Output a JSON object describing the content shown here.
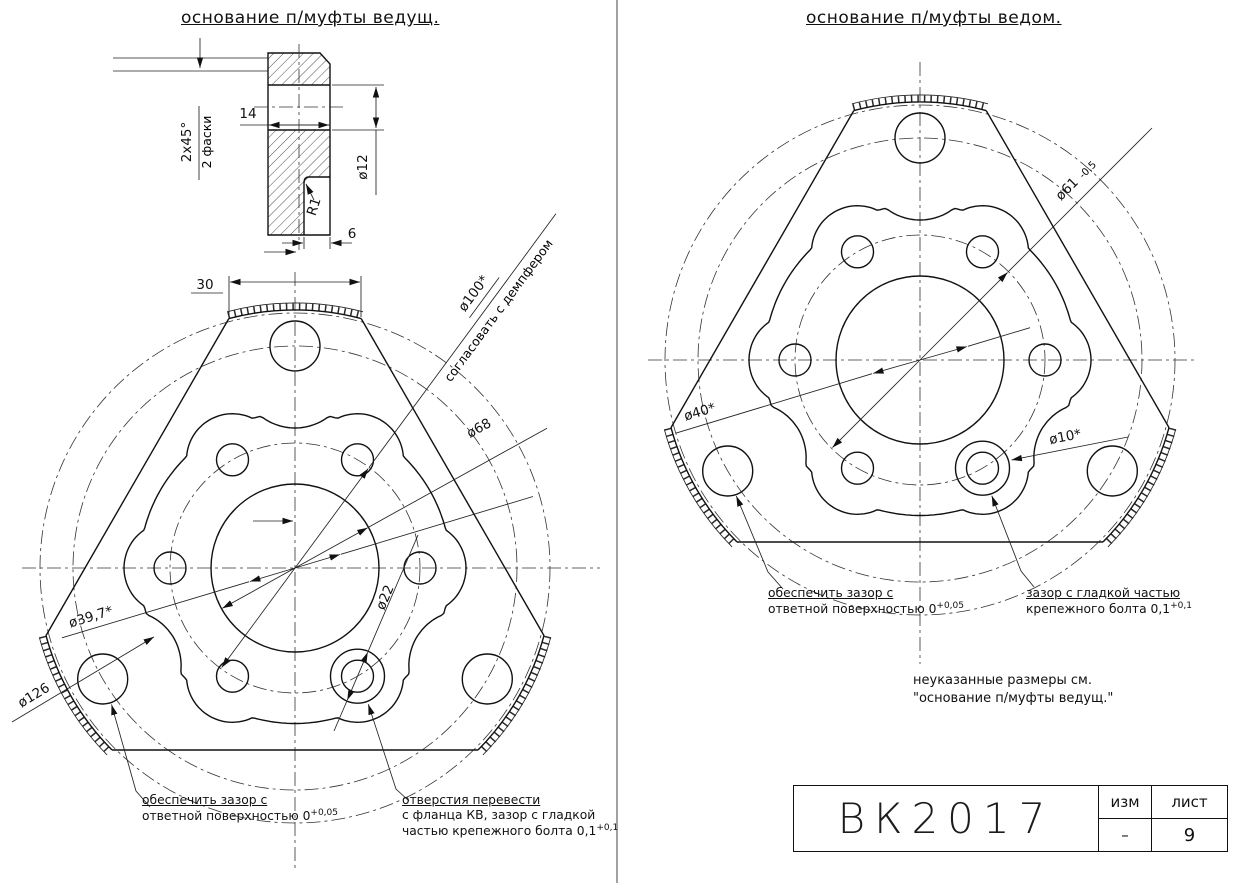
{
  "left_view": {
    "title": "основание п/муфты ведущ.",
    "section": {
      "chamfer_line1": "2x45°",
      "chamfer_line2": "2 фаски",
      "width": "14",
      "bore": "ø12",
      "radius": "R1",
      "slot": "6"
    },
    "dims": {
      "flat": "30",
      "bolt_circle": "ø100*",
      "bolt_circle_note": "согласовать с демпфером",
      "bore": "ø68",
      "counterbore": "ø22",
      "fit": "ø39,7*",
      "flange": "ø126"
    },
    "notes": {
      "clearance": {
        "line1": "обеспечить зазор с",
        "line2": "ответной поверхностью 0",
        "tol": "+0,05"
      },
      "holes": {
        "line1": "отверстия перевести",
        "line2": "с фланца КВ, зазор с гладкой",
        "line3": "частью крепежного болта 0,1",
        "tol": "+0,1"
      }
    }
  },
  "right_view": {
    "title": "основание п/муфты ведом.",
    "dims": {
      "bolt_circle": "ø61",
      "bolt_circle_tol": "-0,5",
      "fit": "ø40*",
      "hole": "ø10*"
    },
    "notes": {
      "clearance": {
        "line1": "обеспечить зазор с",
        "line2": "ответной поверхностью 0",
        "tol": "+0,05"
      },
      "bolt": {
        "line1": "зазор с гладкой частью",
        "line2": "крепежного болта 0,1",
        "tol": "+0,1"
      },
      "reference": {
        "line1": "неуказанные размеры см.",
        "line2": "\"основание п/муфты ведущ.\""
      }
    }
  },
  "title_block": {
    "doc_number": "ВК2017",
    "col_rev": "изм",
    "col_sheet": "лист",
    "rev_value": "–",
    "sheet_value": "9"
  }
}
